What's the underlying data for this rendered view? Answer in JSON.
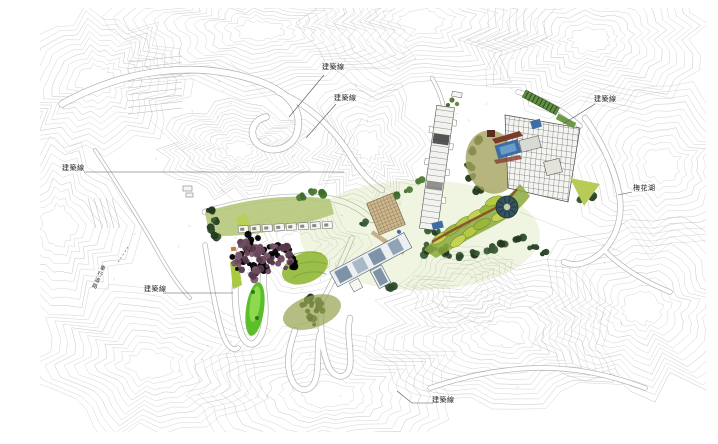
{
  "document": {
    "type": "landscape-master-plan",
    "description_visible_content_only": "topographic site plan with contour lines, roads, building clusters and planting"
  },
  "annotations": {
    "items": [
      {
        "id": "building-line-top-1",
        "text": "建築線"
      },
      {
        "id": "building-line-top-2",
        "text": "建築線"
      },
      {
        "id": "building-line-right",
        "text": "建築線"
      },
      {
        "id": "building-line-left",
        "text": "建築線"
      },
      {
        "id": "building-line-bottom-left",
        "text": "建築線"
      },
      {
        "id": "building-line-bottom",
        "text": "建築線"
      },
      {
        "id": "lake-label",
        "text": "梅花湖"
      },
      {
        "id": "road-label-vertical",
        "text": "車行道路"
      }
    ]
  },
  "palette": {
    "contour_gray": "#c2c2c2",
    "road_casing": "#9a9a9a",
    "lawn_green": "#b5c87a",
    "terrace_green_light": "#c4d34f",
    "terrace_green": "#9ab83a",
    "foliage_dark": "#2d4a2b",
    "foliage_purple": "#6d4a5e",
    "water_blue": "#3d6da4",
    "path_brown": "#8a5530",
    "roof_slate": "#7e93a8",
    "plaza_teal": "#34535c",
    "label_text": "#222222"
  }
}
